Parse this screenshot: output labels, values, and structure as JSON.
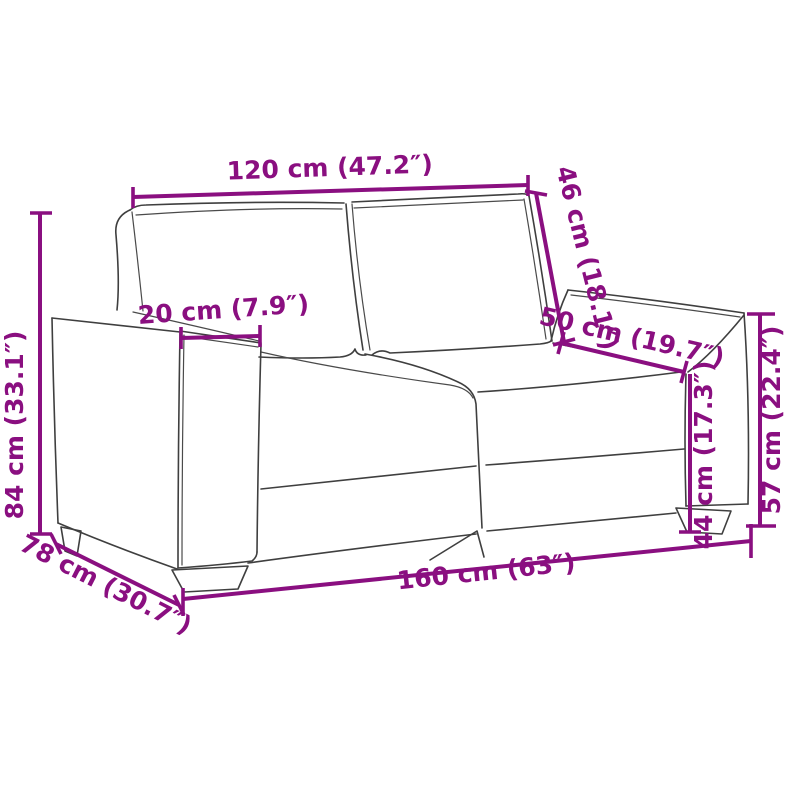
{
  "figure": {
    "type": "product dimension line drawing",
    "subject": "2-seater sofa (loveseat), three-quarter front-left view"
  },
  "colors": {
    "dimension_accent": "#8a0f80",
    "outline": "#3f3f3f",
    "background": "#ffffff"
  },
  "dimensions": {
    "back_width": "120 cm (47.2″)",
    "back_height": "46 cm (18.1″)",
    "armrest_width": "20 cm (7.9″)",
    "seat_depth": "50 cm (19.7″)",
    "total_height": "84 cm (33.1″)",
    "seat_height": "44 cm (17.3″)",
    "armrest_height": "57 cm (22.4″)",
    "total_width": "160 cm (63″)",
    "total_depth": "78 cm (30.7″)"
  }
}
